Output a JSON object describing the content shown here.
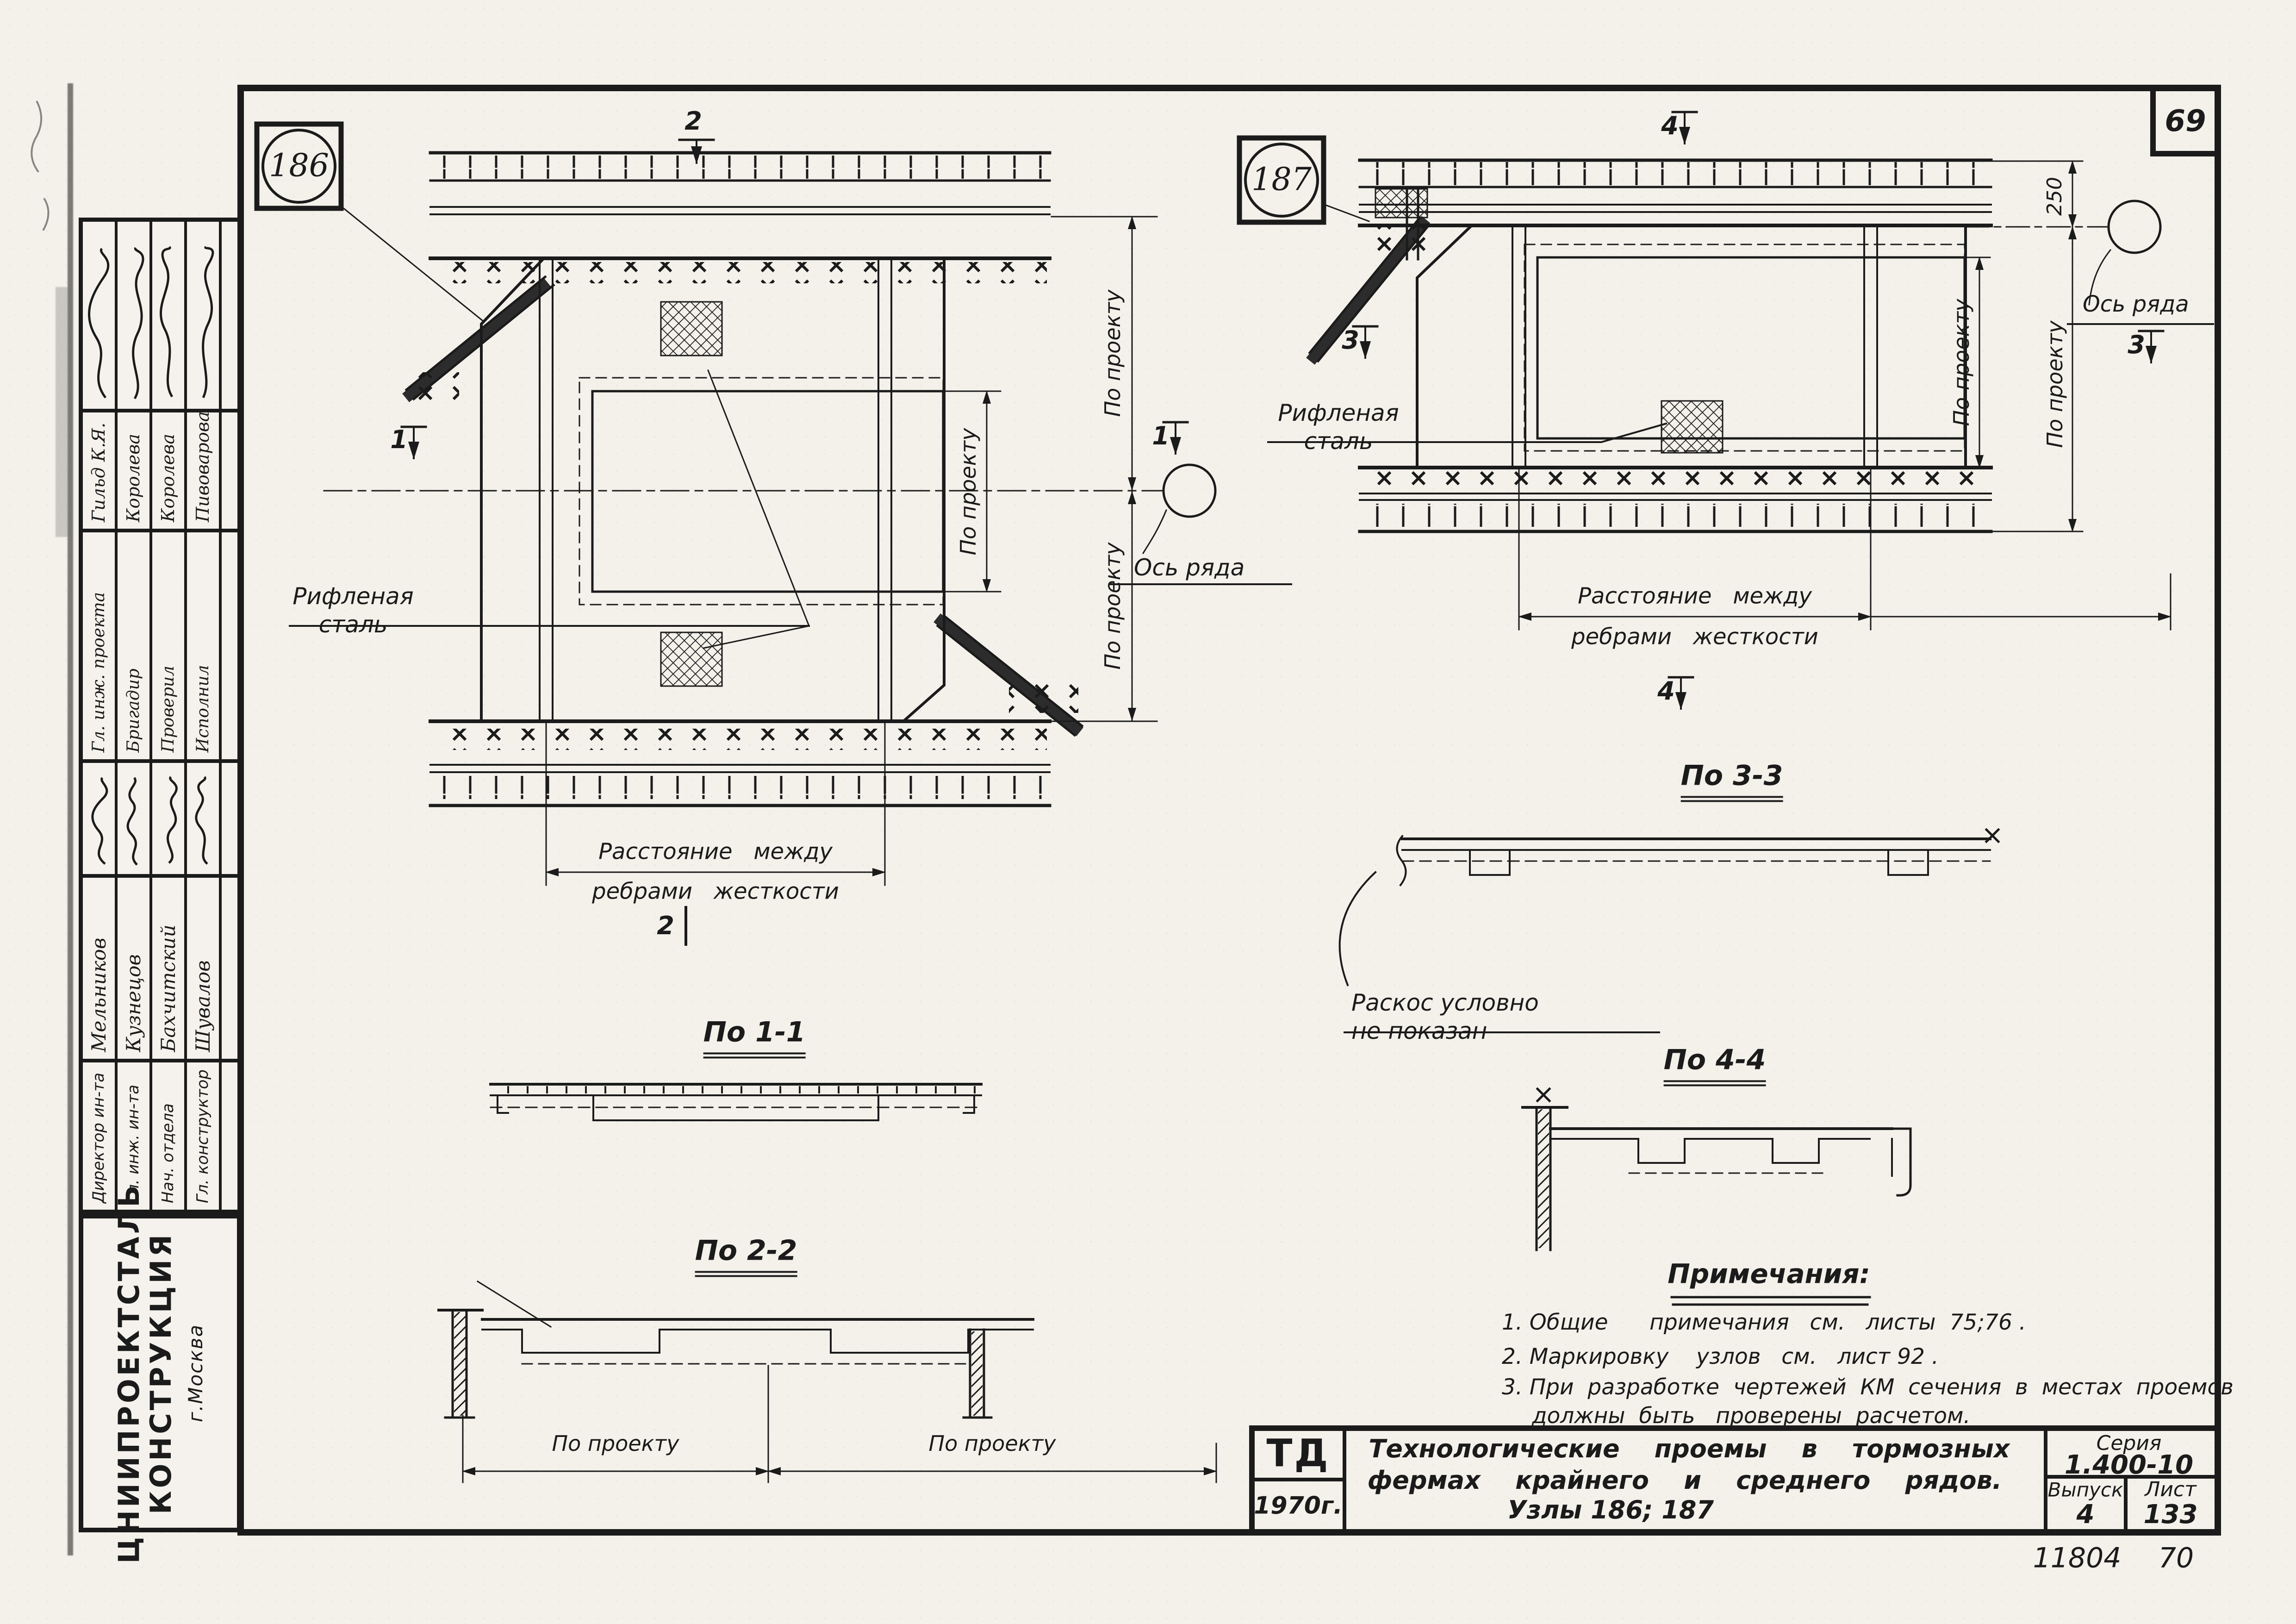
{
  "sheet": {
    "corner_number": "69",
    "archive_left": "11804",
    "archive_right": "70"
  },
  "nodes": {
    "left": "186",
    "right": "187"
  },
  "labels": {
    "riffled_steel": "Рифленая\nсталь",
    "rib_distance_top": "Расстояние   между",
    "rib_distance_bottom": "ребрами   жесткости",
    "row_axis": "Ось ряда",
    "by_project": "По проекту",
    "dim_250": "250",
    "brace_note": "Раскос   условно\nне  показан"
  },
  "sections": [
    {
      "num": "1",
      "title": "По 1-1"
    },
    {
      "num": "2",
      "title": "По 2-2"
    },
    {
      "num": "3",
      "title": "По 3-3"
    },
    {
      "num": "4",
      "title": "По 4-4"
    }
  ],
  "notes": {
    "title": "Примечания:",
    "item1": "1. Общие      примечания   см.   листы  75;76 .",
    "item2": "2. Маркировку    узлов   см.   лист 92 .",
    "item3": "3. При  разработке  чертежей  КМ  сечения  в  местах  проемов",
    "item3b": "должны  быть   проверены  расчетом."
  },
  "title_block": {
    "org_mark": "ТД",
    "year": "1970г.",
    "line1": "Технологические    проемы    в    тормозных",
    "line2": "фермах    крайнего    и    среднего    рядов.",
    "line3": "Узлы 186; 187",
    "series_label": "Серия",
    "series_value": "1.400-10",
    "issue_label": "Выпуск",
    "issue_value": "4",
    "sheet_label": "Лист",
    "sheet_value": "133"
  },
  "stamp": {
    "institute_line1": "ЦНИИПРОЕКТСТАЛЬ",
    "institute_line2": "КОНСТРУКЦИЯ",
    "institute_city": "г.Москва",
    "rows_design": [
      {
        "role": "Гл. инж. проекта",
        "name": "Гильд К.Я."
      },
      {
        "role": "Бригадир",
        "name": "Королева"
      },
      {
        "role": "Проверил",
        "name": "Королева"
      },
      {
        "role": "Исполнил",
        "name": "Пивоварова"
      }
    ],
    "rows_management": [
      {
        "role": "Директор ин-та",
        "name": "Мельников"
      },
      {
        "role": "Гл. инж. ин-та",
        "name": "Кузнецов"
      },
      {
        "role": "Нач. отдела",
        "name": "Бахчитский"
      },
      {
        "role": "Гл. конструктор",
        "name": "Шувалов"
      }
    ]
  }
}
